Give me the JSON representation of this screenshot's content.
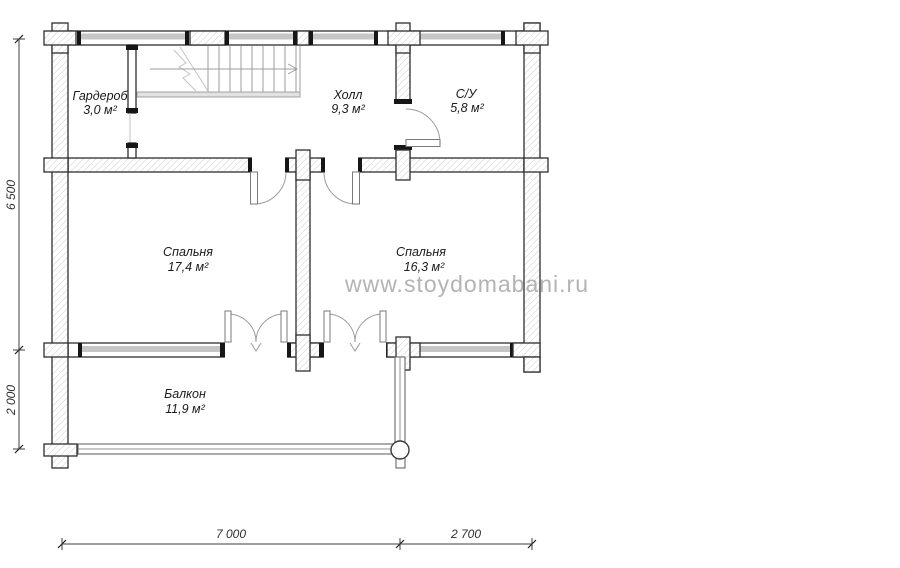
{
  "watermark": {
    "text": "www.stoydomabani.ru",
    "color": "#b3b3b3"
  },
  "rooms": [
    {
      "id": "wardrobe",
      "name": "Гардероб",
      "area": "3,0 м²"
    },
    {
      "id": "hall",
      "name": "Холл",
      "area": "9,3 м²"
    },
    {
      "id": "bathroom",
      "name": "С/У",
      "area": "5,8 м²"
    },
    {
      "id": "bedroom-left",
      "name": "Спальня",
      "area": "17,4 м²"
    },
    {
      "id": "bedroom-right",
      "name": "Спальня",
      "area": "16,3 м²"
    },
    {
      "id": "balcony",
      "name": "Балкон",
      "area": "11,9 м²"
    }
  ],
  "dimensions": {
    "left": [
      "6 500",
      "2 000"
    ],
    "bottom": [
      "7 000",
      "2 700"
    ]
  },
  "colors": {
    "wall_outline": "#2e2e2e",
    "hatch": "#cdcdcd",
    "window_band": "#c6c6c6",
    "dimension": "#2f2f2f"
  }
}
